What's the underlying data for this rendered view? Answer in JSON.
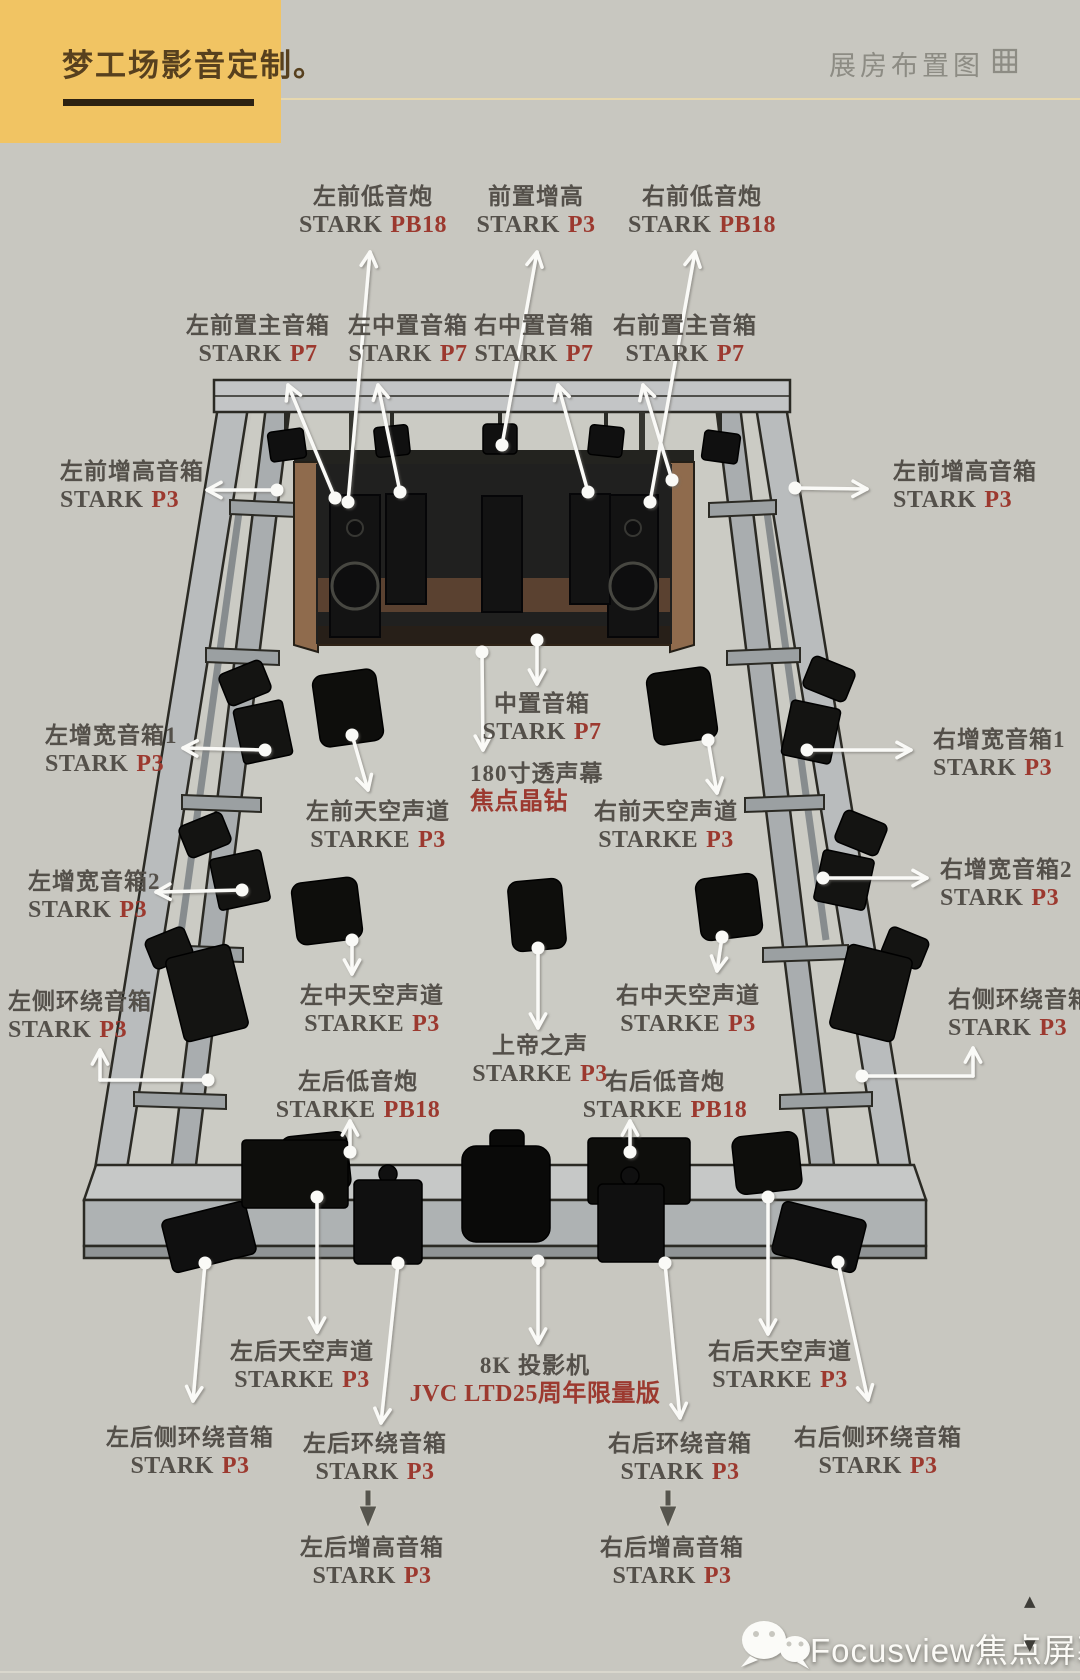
{
  "header": {
    "brand": "梦工场影音定制。",
    "corner_title": "展房布置图"
  },
  "colors": {
    "background": "#c8c7c0",
    "brand_yellow": "#f1c463",
    "label_gray": "#54504a",
    "accent_red": "#9c392f"
  },
  "labels": [
    {
      "name": "front-sub-left",
      "line1": "左前低音炮",
      "model": "STARK",
      "model_red": "PB18",
      "x": 373,
      "y": 183,
      "anchor": "center"
    },
    {
      "name": "front-height-center",
      "line1": "前置增高",
      "model": "STARK",
      "model_red": "P3",
      "x": 536,
      "y": 183,
      "anchor": "center"
    },
    {
      "name": "front-sub-right",
      "line1": "右前低音炮",
      "model": "STARK",
      "model_red": "PB18",
      "x": 702,
      "y": 183,
      "anchor": "center"
    },
    {
      "name": "front-main-left",
      "line1": "左前置主音箱",
      "model": "STARK",
      "model_red": "P7",
      "x": 258,
      "y": 312,
      "anchor": "center"
    },
    {
      "name": "center-left",
      "line1": "左中置音箱",
      "model": "STARK",
      "model_red": "P7",
      "x": 408,
      "y": 312,
      "anchor": "center"
    },
    {
      "name": "center-right",
      "line1": "右中置音箱",
      "model": "STARK",
      "model_red": "P7",
      "x": 534,
      "y": 312,
      "anchor": "center"
    },
    {
      "name": "front-main-right",
      "line1": "右前置主音箱",
      "model": "STARK",
      "model_red": "P7",
      "x": 685,
      "y": 312,
      "anchor": "center"
    },
    {
      "name": "height-front-left",
      "line1": "左前增高音箱",
      "model": "STARK",
      "model_red": "P3",
      "x": 60,
      "y": 458,
      "anchor": "left"
    },
    {
      "name": "height-front-right",
      "line1": "左前增高音箱",
      "model": "STARK",
      "model_red": "P3",
      "x": 893,
      "y": 458,
      "anchor": "left"
    },
    {
      "name": "wide-left-1",
      "line1": "左增宽音箱1",
      "model": "STARK",
      "model_red": "P3",
      "x": 45,
      "y": 722,
      "anchor": "left"
    },
    {
      "name": "wide-right-1",
      "line1": "右增宽音箱1",
      "model": "STARK",
      "model_red": "P3",
      "x": 933,
      "y": 726,
      "anchor": "left"
    },
    {
      "name": "wide-left-2",
      "line1": "左增宽音箱2",
      "model": "STARK",
      "model_red": "P3",
      "x": 28,
      "y": 868,
      "anchor": "left"
    },
    {
      "name": "wide-right-2",
      "line1": "右增宽音箱2",
      "model": "STARK",
      "model_red": "P3",
      "x": 940,
      "y": 856,
      "anchor": "left"
    },
    {
      "name": "side-surround-left",
      "line1": "左侧环绕音箱",
      "model": "STARK",
      "model_red": "P3",
      "x": 8,
      "y": 988,
      "anchor": "left"
    },
    {
      "name": "side-surround-right",
      "line1": "右侧环绕音箱",
      "model": "STARK",
      "model_red": "P3",
      "x": 948,
      "y": 986,
      "anchor": "left"
    },
    {
      "name": "center-channel",
      "line1": "中置音箱",
      "model": "STARK",
      "model_red": "P7",
      "x": 542,
      "y": 690,
      "anchor": "center"
    },
    {
      "name": "screen",
      "line1": "180寸透声幕",
      "model": "",
      "model_red": "焦点晶钻",
      "x": 470,
      "y": 760,
      "anchor": "left"
    },
    {
      "name": "sky-front-left",
      "line1": "左前天空声道",
      "model": "STARKE",
      "model_red": "P3",
      "x": 378,
      "y": 798,
      "anchor": "center"
    },
    {
      "name": "sky-front-right",
      "line1": "右前天空声道",
      "model": "STARKE",
      "model_red": "P3",
      "x": 666,
      "y": 798,
      "anchor": "center"
    },
    {
      "name": "sky-mid-left",
      "line1": "左中天空声道",
      "model": "STARKE",
      "model_red": "P3",
      "x": 372,
      "y": 982,
      "anchor": "center"
    },
    {
      "name": "voice-of-god",
      "line1": "上帝之声",
      "model": "STARKE",
      "model_red": "P3",
      "x": 540,
      "y": 1032,
      "anchor": "center"
    },
    {
      "name": "sky-mid-right",
      "line1": "右中天空声道",
      "model": "STARKE",
      "model_red": "P3",
      "x": 688,
      "y": 982,
      "anchor": "center"
    },
    {
      "name": "sub-rear-left",
      "line1": "左后低音炮",
      "model": "STARKE",
      "model_red": "PB18",
      "x": 358,
      "y": 1068,
      "anchor": "center"
    },
    {
      "name": "sub-rear-right",
      "line1": "右后低音炮",
      "model": "STARKE",
      "model_red": "PB18",
      "x": 665,
      "y": 1068,
      "anchor": "center"
    },
    {
      "name": "sky-rear-left",
      "line1": "左后天空声道",
      "model": "STARKE",
      "model_red": "P3",
      "x": 302,
      "y": 1338,
      "anchor": "center"
    },
    {
      "name": "projector",
      "line1": "8K 投影机",
      "model": "",
      "model_red": "JVC LTD25周年限量版",
      "x": 535,
      "y": 1352,
      "anchor": "center"
    },
    {
      "name": "sky-rear-right",
      "line1": "右后天空声道",
      "model": "STARKE",
      "model_red": "P3",
      "x": 780,
      "y": 1338,
      "anchor": "center"
    },
    {
      "name": "surround-rear-side-left",
      "line1": "左后侧环绕音箱",
      "model": "STARK",
      "model_red": "P3",
      "x": 190,
      "y": 1424,
      "anchor": "center"
    },
    {
      "name": "surround-rear-left",
      "line1": "左后环绕音箱",
      "model": "STARK",
      "model_red": "P3",
      "x": 375,
      "y": 1430,
      "anchor": "center"
    },
    {
      "name": "surround-rear-right",
      "line1": "右后环绕音箱",
      "model": "STARK",
      "model_red": "P3",
      "x": 680,
      "y": 1430,
      "anchor": "center"
    },
    {
      "name": "surround-rear-side-right",
      "line1": "右后侧环绕音箱",
      "model": "STARK",
      "model_red": "P3",
      "x": 878,
      "y": 1424,
      "anchor": "center"
    },
    {
      "name": "height-rear-left",
      "line1": "左后增高音箱",
      "model": "STARK",
      "model_red": "P3",
      "x": 372,
      "y": 1534,
      "anchor": "center"
    },
    {
      "name": "height-rear-right",
      "line1": "右后增高音箱",
      "model": "STARK",
      "model_red": "P3",
      "x": 672,
      "y": 1534,
      "anchor": "center"
    }
  ],
  "footer": {
    "watermark": "Focusview焦点屏幕",
    "up_arrow": "▲",
    "down_arrow": "▼"
  }
}
